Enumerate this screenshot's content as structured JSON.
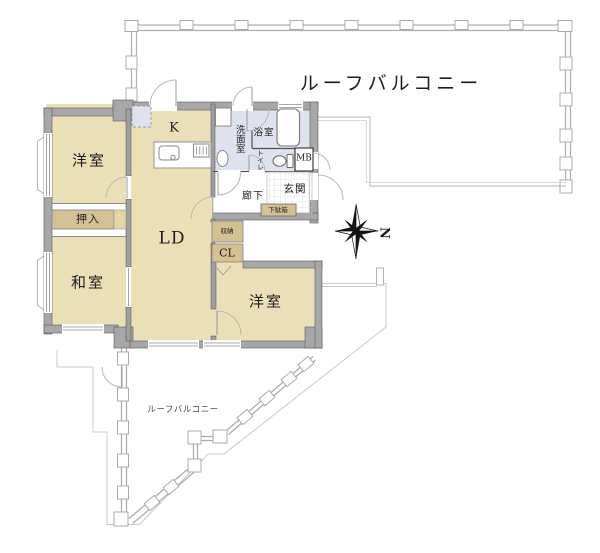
{
  "plan": {
    "balcony_top": "ルーフバルコニー",
    "balcony_bottom": "ルーフバルコニー",
    "compass_north": "N",
    "rooms": {
      "western1": "洋室",
      "oshiire": "押入",
      "japanese": "和室",
      "kitchen": "K",
      "living_dining": "LD",
      "washroom": "洗面室",
      "bathroom": "浴室",
      "toilet": "トイレ",
      "meter_box": "MB",
      "entrance": "玄関",
      "shoe_cabinet": "下駄箱",
      "hallway": "廊下",
      "storage": "収納",
      "closet": "CL",
      "western2": "洋室"
    },
    "colors": {
      "floor_tan": "#EBDFB8",
      "closet_tan": "#D4C093",
      "wet_blue": "#DEE2EE",
      "wall_gray": "#A7A7A7",
      "wall_edge": "#5A5A5A",
      "balcony_line": "#AFAFAF",
      "thin_outline": "#C9C9C9",
      "text": "#1D1D1D"
    }
  }
}
